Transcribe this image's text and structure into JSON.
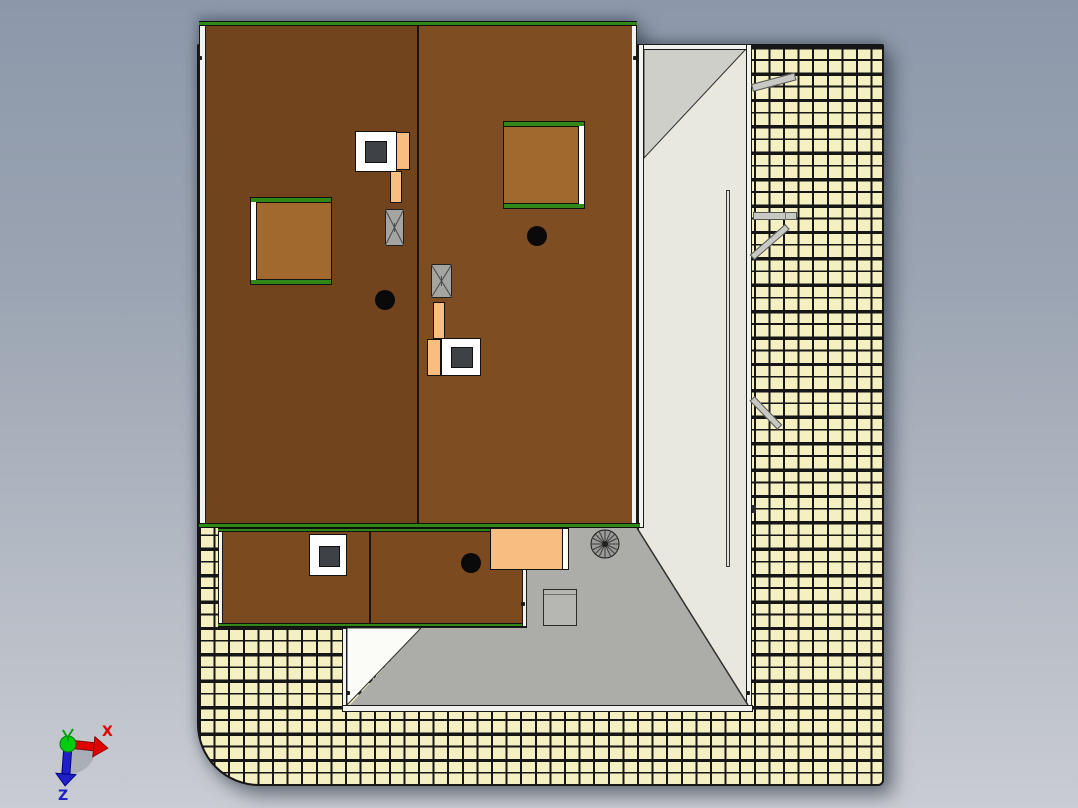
{
  "viewport": {
    "app_kind": "cad-3d-viewport-top-view",
    "background_gradient": {
      "top": "#8c98aa",
      "bottom": "#c9ccd2"
    }
  },
  "triad": {
    "x_label": "X",
    "z_label": "Z",
    "x_color": "#e00000",
    "z_color": "#2020c8",
    "origin_color": "#00cc10",
    "wedge_color": "#9fa5af"
  },
  "palette": {
    "roof_left_panel": "#71441d",
    "roof_right_panel": "#7e4e22",
    "roof_edge_green": "#2f8818",
    "gutter_white": "#f2f2ee",
    "skylight_brown": "#a1692e",
    "chimney_white": "#ffffff",
    "chimney_flue_dark": "#3e4247",
    "pipe_orange": "#f7bd81",
    "vent_gray": "#a4a4a0",
    "drain_black": "#0a0a0a",
    "annex_face": "#e9e8df",
    "annex_shaded_facet": "#cfcfc9",
    "terrace_gray": "#acaca8",
    "hip_facet_white": "#fbfbf7",
    "ground_tile_cream": "#f5f0c1",
    "grid_line": "#161616",
    "beam_gray": "#c9c9c3"
  },
  "inventory": {
    "main_roof_panels": 2,
    "skylights": 2,
    "chimneys": 3,
    "roof_vents": 2,
    "vent_pipes": 2,
    "roof_drains": 3,
    "spiral_staircase": 1,
    "terrace_table": 1,
    "protruding_beams": 4
  }
}
